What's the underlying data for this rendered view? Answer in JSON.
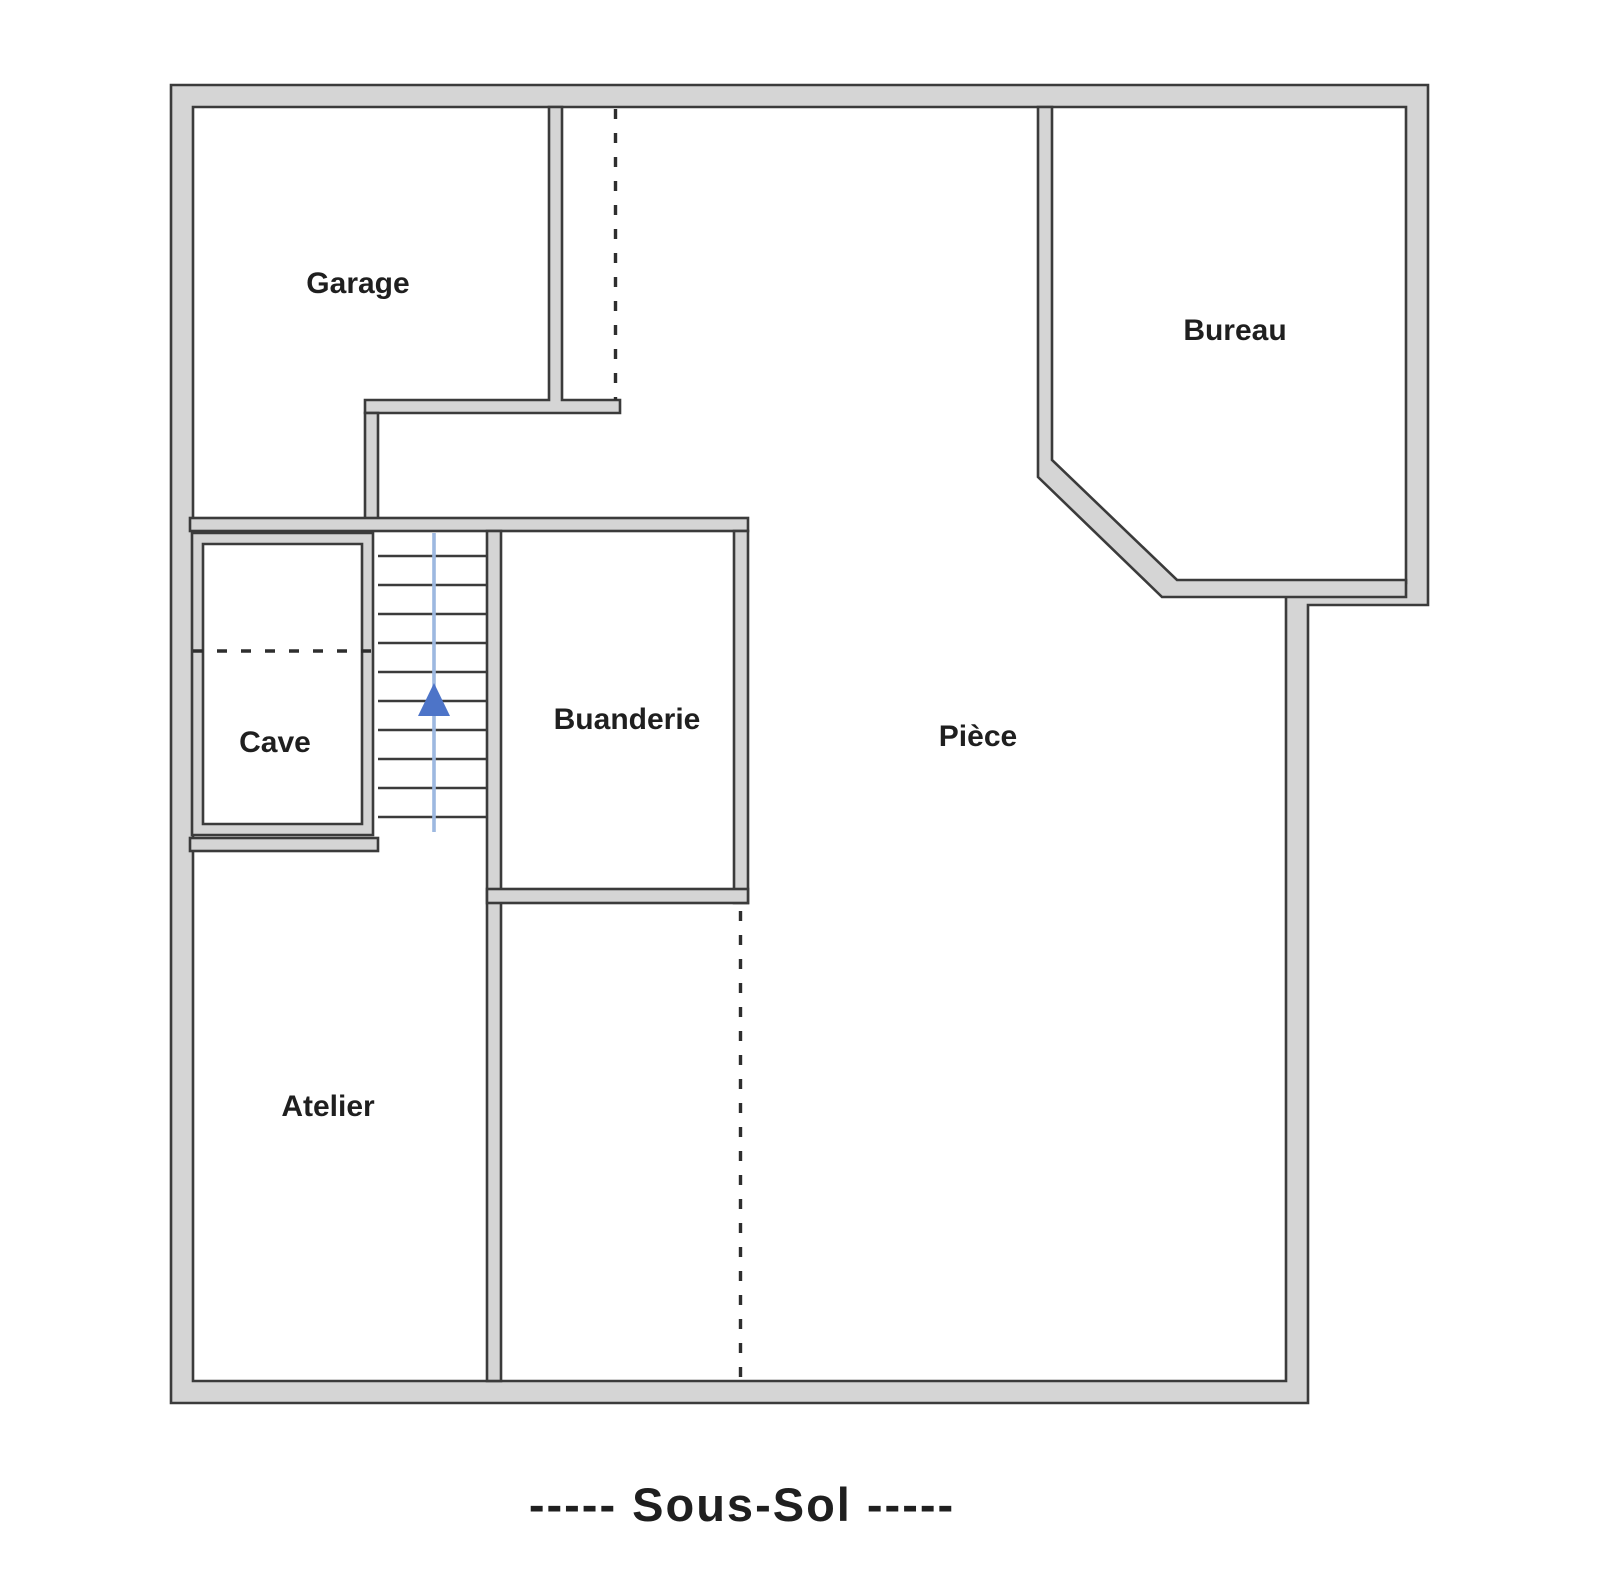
{
  "title": "-----  Sous-Sol  -----",
  "floor": {
    "name": "Sous-Sol"
  },
  "rooms": {
    "garage": {
      "label": "Garage"
    },
    "bureau": {
      "label": "Bureau"
    },
    "cave": {
      "label": "Cave"
    },
    "buanderie": {
      "label": "Buanderie"
    },
    "piece": {
      "label": "Pièce"
    },
    "atelier": {
      "label": "Atelier"
    }
  },
  "stairs": {
    "direction": "up"
  },
  "colors": {
    "wall_fill": "#d5d5d5",
    "wall_edge": "#3b3b3b",
    "background": "#ffffff",
    "label_text": "#1f1f1f",
    "dashed_line": "#2e2e2e",
    "stair_line": "#9db8e0",
    "stair_arrow": "#4d74c8"
  }
}
